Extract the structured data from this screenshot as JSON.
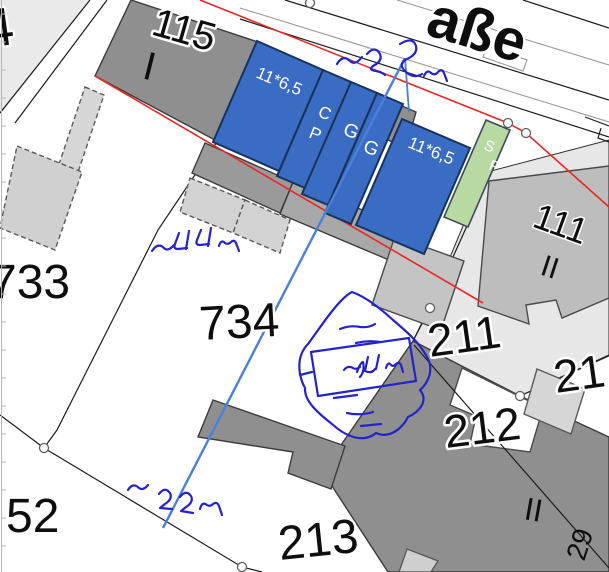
{
  "map": {
    "street_name": "aße",
    "parcel_numbers": [
      "4",
      "115",
      "733",
      "734",
      "52",
      "213",
      "211",
      "212",
      "21",
      "111"
    ],
    "house_number": "29",
    "storey_marks": [
      "I",
      "II",
      "II"
    ],
    "highlight_dimensions": [
      "11*6,5",
      "11*6,5"
    ],
    "building_use_marks": [
      "C",
      "P",
      "G",
      "G",
      "S",
      "P"
    ],
    "handwritten_notes": {
      "top": "~2,5m",
      "left": "~44m",
      "sketch_center": "~44m",
      "bottom": "~22m"
    }
  },
  "labels": [
    {
      "name": "street-name",
      "text": "aße"
    },
    {
      "name": "parcel-4",
      "text": "4"
    },
    {
      "name": "parcel-115",
      "text": "115"
    },
    {
      "name": "storeys-115",
      "text": "I"
    },
    {
      "name": "parcel-733",
      "text": "733"
    },
    {
      "name": "parcel-734",
      "text": "734"
    },
    {
      "name": "parcel-52",
      "text": "52"
    },
    {
      "name": "parcel-213",
      "text": "213"
    },
    {
      "name": "parcel-211",
      "text": "211"
    },
    {
      "name": "parcel-212",
      "text": "212"
    },
    {
      "name": "parcel-21",
      "text": "21"
    },
    {
      "name": "parcel-111",
      "text": "111"
    },
    {
      "name": "storeys-111",
      "text": "II"
    },
    {
      "name": "storeys-212",
      "text": "II"
    },
    {
      "name": "house-29",
      "text": "29"
    },
    {
      "name": "dim-left-block",
      "text": "11*6,5"
    },
    {
      "name": "dim-right-block",
      "text": "11*6,5"
    },
    {
      "name": "mark-c",
      "text": "C"
    },
    {
      "name": "mark-p1",
      "text": "P"
    },
    {
      "name": "mark-g1",
      "text": "G"
    },
    {
      "name": "mark-g2",
      "text": "G"
    },
    {
      "name": "mark-s",
      "text": "S"
    },
    {
      "name": "mark-p2",
      "text": "P"
    }
  ],
  "colors": {
    "highlight_blue": "#3a6cc4",
    "highlight_blue_border": "#17335c",
    "highlight_green": "#b9d9a3",
    "alignment_red": "#e82828",
    "measure_blue": "#4a80d9",
    "ink_blue": "#2323cc",
    "building_dark": "#8f8f8f",
    "building_medium": "#c4c4c4",
    "building_light": "#d6d6d6",
    "parcel_light": "#e7e7e7"
  }
}
